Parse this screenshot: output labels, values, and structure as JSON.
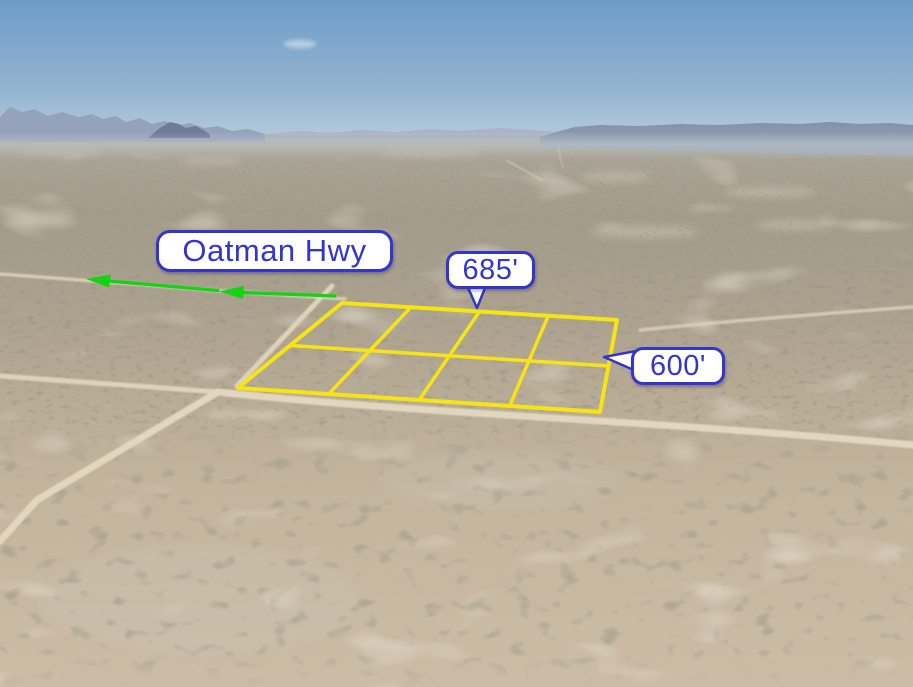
{
  "labels": {
    "highway": "Oatman Hwy",
    "parcel_width": "685'",
    "parcel_depth": "600'"
  },
  "colors": {
    "annotation_blue": "#3434d0",
    "bubble_background": "#ffffff",
    "parcel_outline_yellow": "#f6e513",
    "arrow_green": "#12d412"
  },
  "icons": {
    "direction_arrow": "←"
  }
}
